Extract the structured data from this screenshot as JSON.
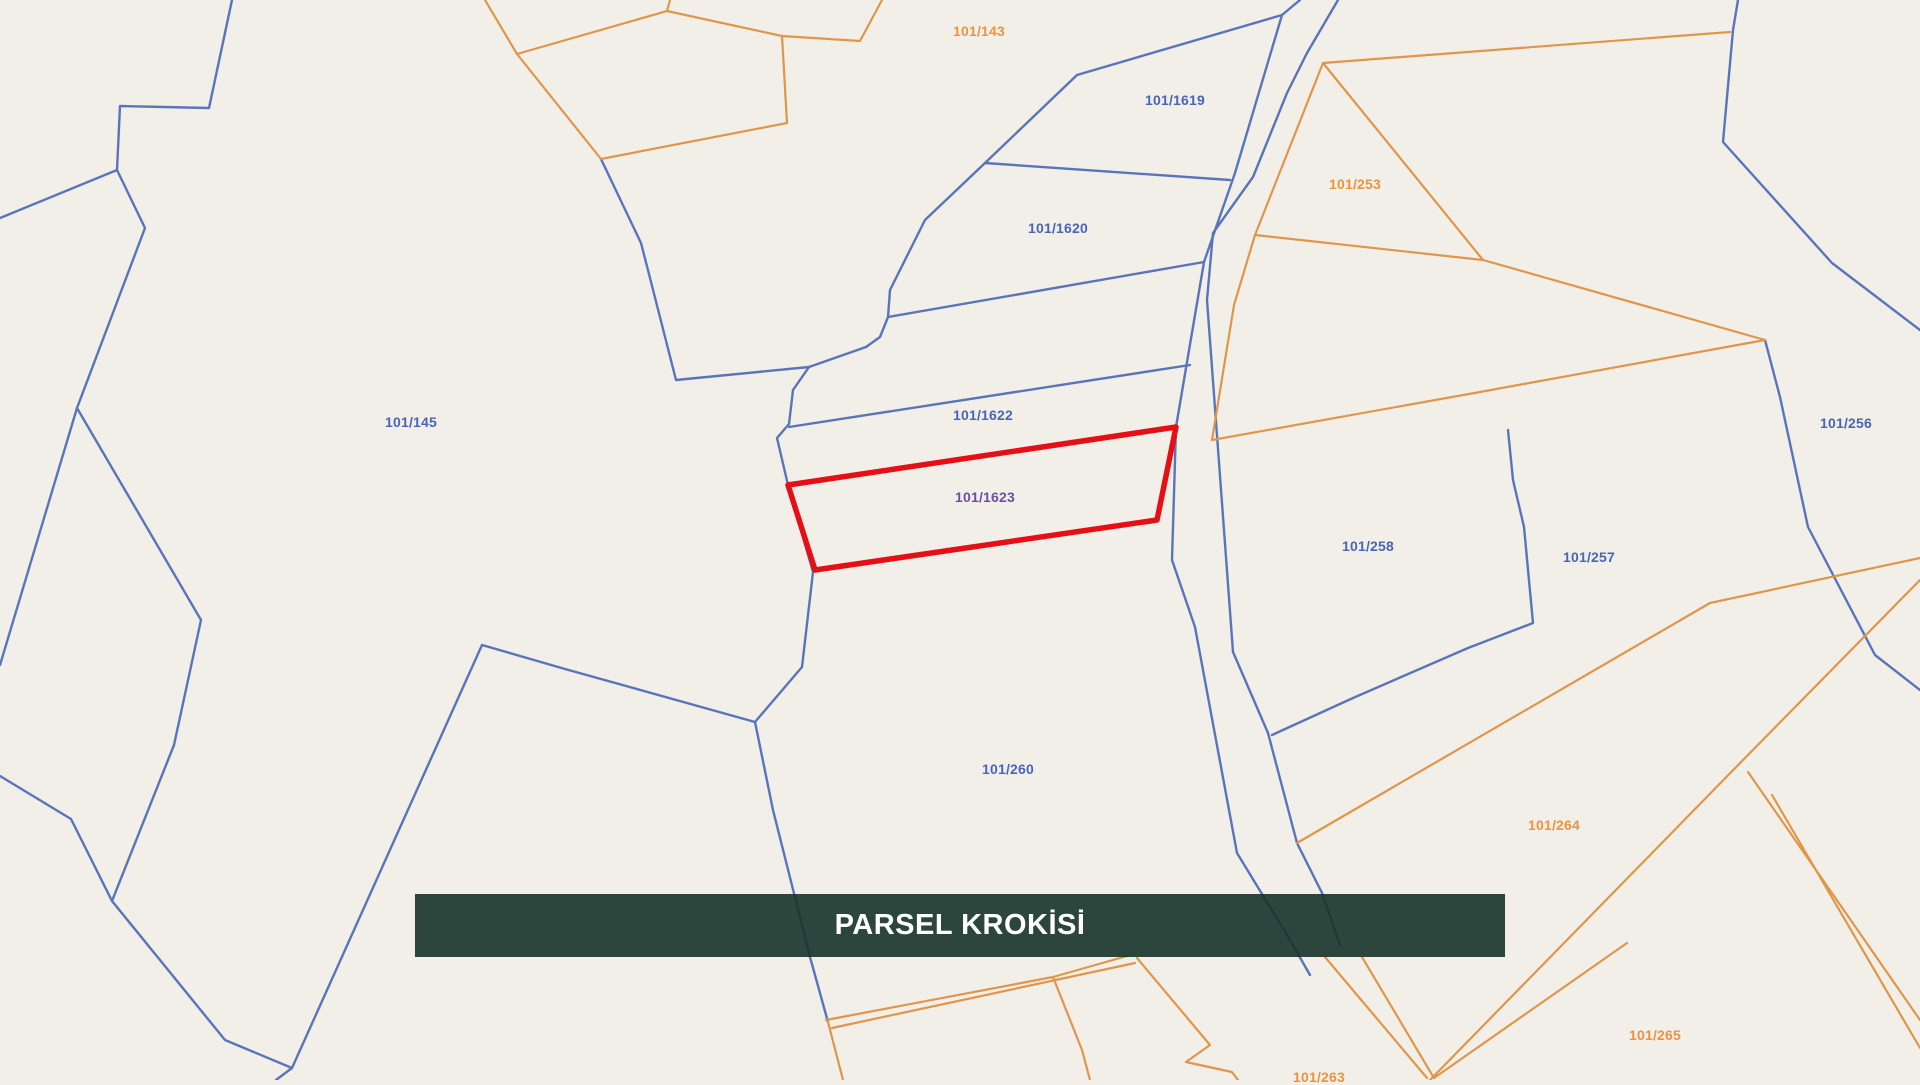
{
  "banner": {
    "title": "PARSEL KROKİSİ"
  },
  "colors": {
    "background": "#f2efe9",
    "line_blue": "#5a74ba",
    "line_orange": "#e0964a",
    "label_blue": "#4a65b2",
    "label_orange": "#ea9440",
    "label_purple": "#6d4f9e",
    "highlight_fill": "#efb6b2",
    "highlight_stroke": "#e60f15",
    "banner_bg": "rgba(22,51,43,0.9)",
    "banner_text": "#ffffff"
  },
  "highlighted_parcel": {
    "id": "101/1623"
  },
  "parcels": [
    {
      "id": "101/143",
      "x": 979,
      "y": 31,
      "color": "orange"
    },
    {
      "id": "101/1619",
      "x": 1175,
      "y": 100,
      "color": "blue"
    },
    {
      "id": "101/253",
      "x": 1355,
      "y": 184,
      "color": "orange"
    },
    {
      "id": "101/1620",
      "x": 1058,
      "y": 228,
      "color": "blue"
    },
    {
      "id": "101/1622",
      "x": 983,
      "y": 415,
      "color": "blue"
    },
    {
      "id": "101/145",
      "x": 411,
      "y": 422,
      "color": "blue"
    },
    {
      "id": "101/256",
      "x": 1846,
      "y": 423,
      "color": "blue"
    },
    {
      "id": "101/1623",
      "x": 985,
      "y": 497,
      "color": "purple"
    },
    {
      "id": "101/258",
      "x": 1368,
      "y": 546,
      "color": "blue"
    },
    {
      "id": "101/257",
      "x": 1589,
      "y": 557,
      "color": "blue"
    },
    {
      "id": "101/260",
      "x": 1008,
      "y": 769,
      "color": "blue"
    },
    {
      "id": "101/264",
      "x": 1554,
      "y": 825,
      "color": "orange"
    },
    {
      "id": "101/265",
      "x": 1655,
      "y": 1035,
      "color": "orange"
    },
    {
      "id": "101/263",
      "x": 1319,
      "y": 1077,
      "color": "orange"
    }
  ]
}
